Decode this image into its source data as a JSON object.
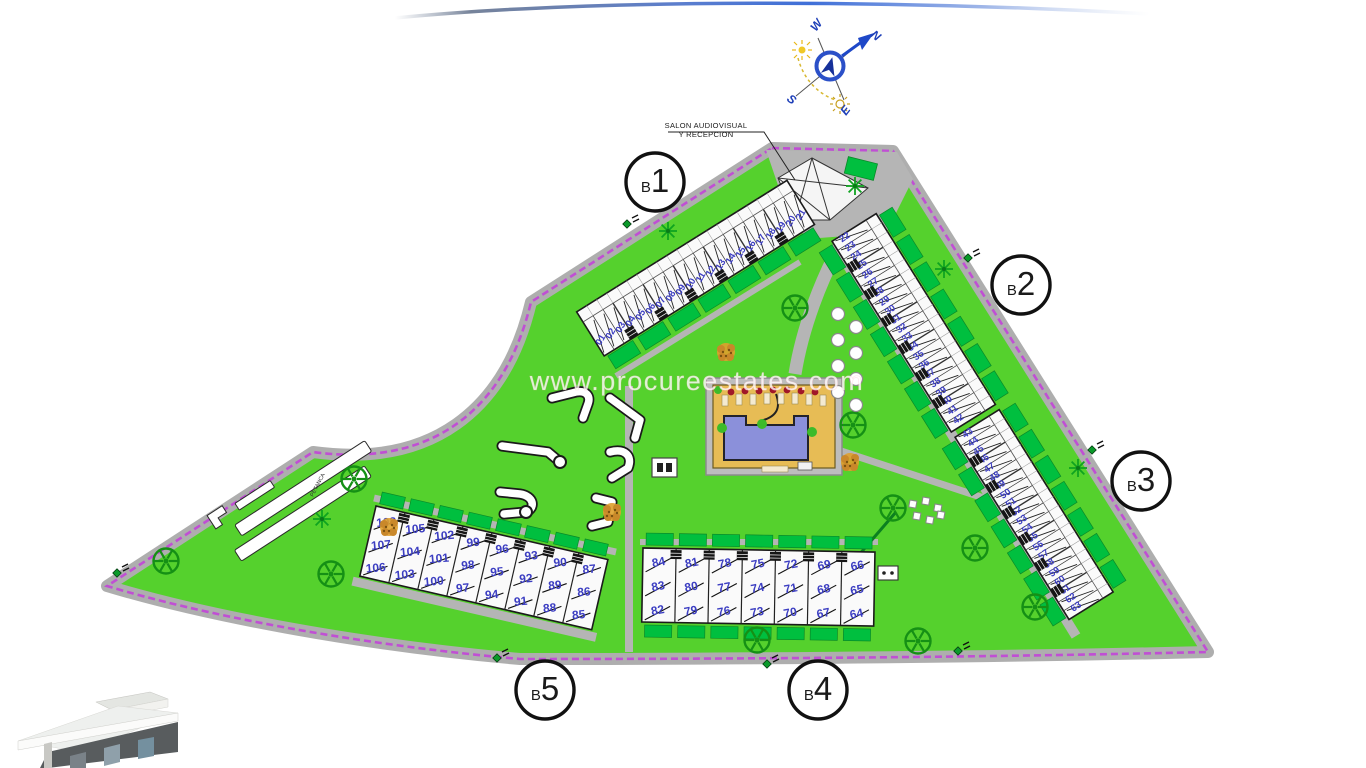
{
  "watermark": "www.procureestates.com",
  "compass": {
    "n": "N",
    "w": "W",
    "s": "S",
    "e": "E"
  },
  "callouts": {
    "reception_line1": "SALON AUDIOVISUAL",
    "reception_line2": "Y RECEPCION",
    "petanca": "PETANCA"
  },
  "blocks": [
    {
      "id": "b1",
      "label": "B1",
      "units": [
        "01",
        "02",
        "03",
        "04",
        "05",
        "06",
        "07",
        "08",
        "09",
        "10",
        "11",
        "12",
        "13",
        "14",
        "15",
        "16",
        "17",
        "18",
        "19",
        "20",
        "21"
      ]
    },
    {
      "id": "b2",
      "label": "B2",
      "units": [
        "22",
        "23",
        "24",
        "25",
        "26",
        "27",
        "28",
        "29",
        "30",
        "31",
        "32",
        "33",
        "34",
        "35",
        "36",
        "37",
        "38",
        "39",
        "40",
        "41",
        "42"
      ]
    },
    {
      "id": "b3",
      "label": "B3",
      "units": [
        "43",
        "44",
        "45",
        "46",
        "47",
        "48",
        "49",
        "50",
        "51",
        "52",
        "53",
        "54",
        "55",
        "56",
        "57",
        "58",
        "59",
        "60",
        "61",
        "62",
        "63"
      ]
    },
    {
      "id": "b4",
      "label": "B4",
      "units": [
        "64",
        "65",
        "66",
        "67",
        "68",
        "69",
        "70",
        "71",
        "72",
        "73",
        "74",
        "75",
        "76",
        "77",
        "78",
        "79",
        "80",
        "81",
        "82",
        "83",
        "84"
      ]
    },
    {
      "id": "b5",
      "label": "B5",
      "units": [
        "85",
        "86",
        "87",
        "88",
        "89",
        "90",
        "91",
        "92",
        "93",
        "94",
        "95",
        "96",
        "97",
        "98",
        "99",
        "100",
        "101",
        "102",
        "103",
        "104",
        "105",
        "106",
        "107",
        "108"
      ]
    }
  ],
  "icons": {
    "tree": "tree-icon",
    "palm": "palm-icon",
    "shrub": "shrub-icon",
    "gate": "gate-icon",
    "compass": "compass-rose-icon",
    "umbrella": "umbrella-icon"
  },
  "colors": {
    "grass": "#55d12d",
    "hedge": "#00bf3f",
    "road": "#b5b5b5",
    "boundary": "#c04fd4",
    "building_fill": "#fafafa",
    "unit_number": "#3c3ec2",
    "pool_water": "#8b90da",
    "pool_deck": "#e7bc55",
    "swoosh_blue": "#4a74d8",
    "tree_green": "#159015"
  }
}
